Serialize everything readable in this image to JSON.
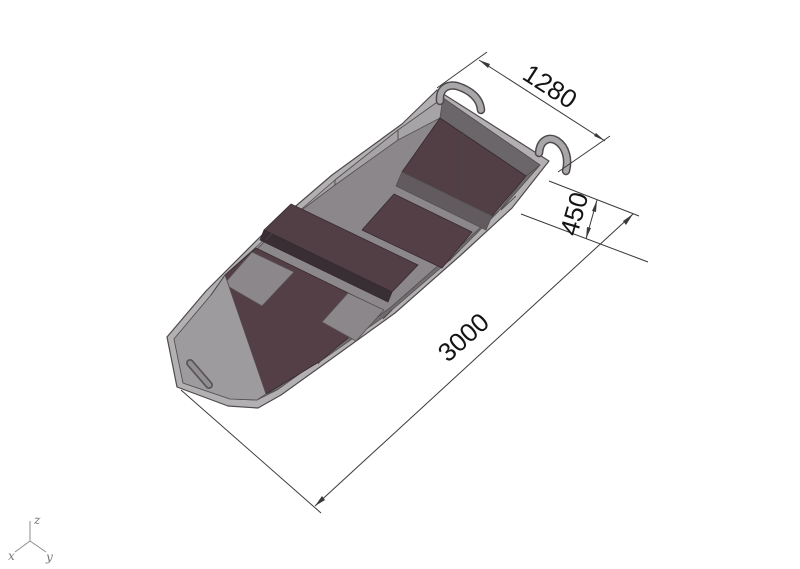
{
  "model": {
    "dimensions": {
      "beam": {
        "value": "1280"
      },
      "depth": {
        "value": "450"
      },
      "length": {
        "value": "3000"
      }
    },
    "axis_triad": {
      "x_label": "x",
      "y_label": "y",
      "z_label": "z"
    }
  },
  "colors": {
    "background": "#ffffff",
    "gunwale_light": "#b3b0b3",
    "interior_base": "#8b878a",
    "port_wall": "#a7a4a7",
    "starboard_wall": "#716c70",
    "transom_face": "#6b6669",
    "bow_plate": "#9e9b9e",
    "deck_brown": "#523f45",
    "bench_brown": "#523e45",
    "floor_brown": "#543f46",
    "dark_face": "#392e33",
    "deck_face_gray": "#615b5f",
    "dimension_line": "#3a3a3a",
    "dimension_text": "#141414",
    "axis_gray": "#8c8c8c"
  }
}
